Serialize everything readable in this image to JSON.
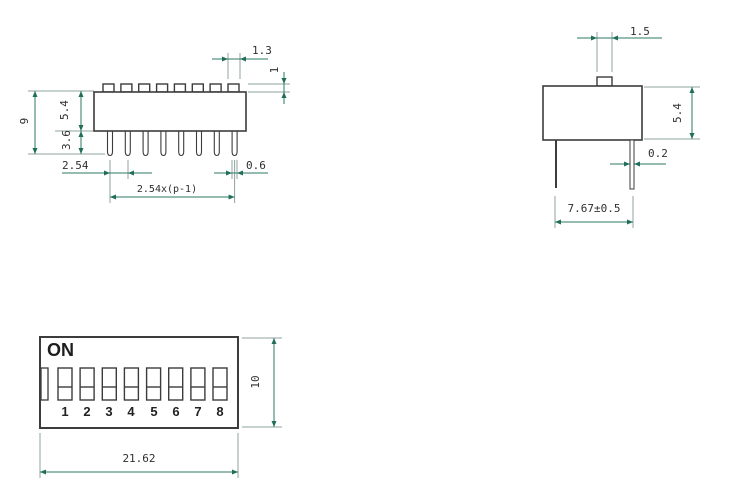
{
  "drawing": {
    "side_view": {
      "dims": {
        "actuator_width": "1.3",
        "actuator_height": "1",
        "overall_height": "9",
        "body_height": "5.4",
        "pin_length": "3.6",
        "pin_pitch": "2.54",
        "pin_span": "2.54x(p-1)",
        "pin_width": "0.6"
      }
    },
    "end_view": {
      "dims": {
        "actuator_width": "1.5",
        "body_height": "5.4",
        "pin_thickness": "0.2",
        "pin_row_spacing": "7.67±0.5"
      }
    },
    "top_view": {
      "on_label": "ON",
      "switch_numbers": [
        "1",
        "2",
        "3",
        "4",
        "5",
        "6",
        "7",
        "8"
      ],
      "dims": {
        "overall_length": "21.62",
        "overall_width": "10"
      }
    }
  },
  "colors": {
    "outline": "#3c3c3c",
    "dimension_line": "#2e7a66",
    "extension_line": "#8fa39d",
    "arrow": "#1e6e59",
    "text": "#2f2f2f"
  }
}
